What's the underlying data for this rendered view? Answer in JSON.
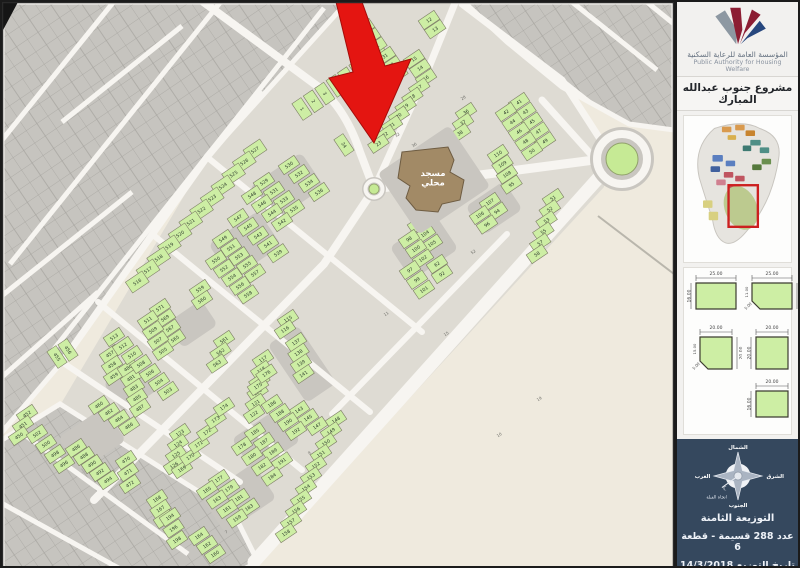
{
  "sidebar": {
    "org_name_ar": "المؤسسة العامة للرعاية السكنية",
    "org_name_en": "Public Authority for Housing Welfare",
    "project_title": "مشروع جنوب عبدالله المبارك",
    "compass": {
      "north": "الشمال",
      "east": "الشرق",
      "west": "الغرب",
      "south": "الجنوب",
      "qibla": "اتجاه القبلة"
    },
    "plot_diagrams": [
      {
        "top": "25.00",
        "side": "16.00",
        "side_pos": "left",
        "chamfer": null
      },
      {
        "top": "25.00",
        "side": "16.00",
        "side_pos": "right",
        "chamfer": [
          "11.00",
          "5.00"
        ]
      },
      {
        "top": "20.00",
        "side": "20.00",
        "side_pos": "right",
        "chamfer": [
          "15.00",
          "5.00"
        ]
      },
      {
        "top": "20.00",
        "side": "20.00",
        "side_pos": "left",
        "chamfer": null
      },
      {
        "top": "20.00",
        "side": "16.00",
        "side_pos": "left",
        "chamfer": null
      }
    ],
    "footer": {
      "line1": "التوزيعة الثامنة",
      "line2": "عدد 288 قسيمة - قطعة 6",
      "line3": "تاريخ التوزيع 14/3/2018"
    }
  },
  "map": {
    "mosque_label_lines": [
      "مسجد",
      "محلي"
    ],
    "colors": {
      "plot_green": "#cdeea4",
      "plot_stroke": "#7c7c64",
      "road": "#f7f5f1",
      "dev_base": "#dedbd3",
      "gray_zone": "#c6c4bf",
      "desert": "#efeade",
      "court": "#c9c6c0",
      "mosque": "#a28a66",
      "arrow_red": "#e41511",
      "roundabout_green": "#c6ea95",
      "footer_navy": "#35485e"
    },
    "street_numbers": [
      {
        "n": "32",
        "x": 396,
        "y": 134
      },
      {
        "n": "36",
        "x": 413,
        "y": 144
      },
      {
        "n": "28",
        "x": 462,
        "y": 97
      },
      {
        "n": "52",
        "x": 472,
        "y": 251
      },
      {
        "n": "15",
        "x": 445,
        "y": 333
      },
      {
        "n": "11",
        "x": 385,
        "y": 313
      },
      {
        "n": "19",
        "x": 538,
        "y": 398
      },
      {
        "n": "10",
        "x": 498,
        "y": 434
      },
      {
        "n": "9",
        "x": 308,
        "y": 452
      },
      {
        "n": "7",
        "x": 225,
        "y": 531
      }
    ],
    "blocks": [
      {
        "t": "r",
        "x": 300,
        "y": 107,
        "dx": 11.4,
        "dy": -7.7,
        "nums": [
          1,
          2,
          3,
          4,
          5,
          6,
          7,
          8
        ]
      },
      {
        "t": "c",
        "x": 362,
        "y": 26,
        "dx": 6.2,
        "dy": 9.2,
        "nums": [
          9,
          10,
          11
        ]
      },
      {
        "t": "c",
        "x": 427,
        "y": 18,
        "dx": 6.2,
        "dy": 9.2,
        "nums": [
          12,
          13
        ]
      },
      {
        "t": "c",
        "x": 383,
        "y": 54,
        "dx": 6.2,
        "dy": 9.2,
        "nums": [
          31,
          33,
          35
        ]
      },
      {
        "t": "c",
        "x": 412,
        "y": 57,
        "dx": 6.2,
        "dy": 9.2,
        "nums": [
          15,
          14
        ]
      },
      {
        "t": "c",
        "x": 424,
        "y": 76,
        "dx": -6.8,
        "dy": 9.4,
        "nums": [
          16,
          17,
          18,
          19,
          20,
          21,
          22,
          23
        ]
      },
      {
        "t": "r",
        "x": 342,
        "y": 143,
        "dx": 0,
        "dy": 0,
        "nums": [
          24
        ]
      },
      {
        "t": "c",
        "x": 464,
        "y": 110,
        "dx": -3,
        "dy": 10.5,
        "nums": [
          36,
          37,
          38
        ]
      },
      {
        "t": "c",
        "x": 517,
        "y": 100,
        "dx": 6.5,
        "dy": 9.8,
        "nums": [
          41,
          43,
          45,
          47,
          49
        ]
      },
      {
        "t": "c",
        "x": 504,
        "y": 110,
        "dx": 6.5,
        "dy": 9.8,
        "nums": [
          42,
          44,
          46,
          48,
          50
        ]
      },
      {
        "t": "c",
        "x": 496,
        "y": 152,
        "dx": 4.5,
        "dy": 10.2,
        "nums": [
          110,
          109,
          108,
          95
        ]
      },
      {
        "t": "c",
        "x": 551,
        "y": 196,
        "dx": -3.2,
        "dy": 11.2,
        "nums": [
          51,
          52,
          53,
          55,
          57,
          58
        ]
      },
      {
        "t": "c",
        "x": 488,
        "y": 200,
        "dx": 7,
        "dy": 9.5,
        "nums": [
          107,
          94
        ]
      },
      {
        "t": "c",
        "x": 478,
        "y": 213,
        "dx": 7,
        "dy": 9.5,
        "nums": [
          106,
          96
        ]
      },
      {
        "t": "c",
        "x": 416,
        "y": 222,
        "dx": 7,
        "dy": 9.8,
        "nums": [
          103,
          104,
          105
        ]
      },
      {
        "t": "c",
        "x": 407,
        "y": 237,
        "dx": 7,
        "dy": 9.8,
        "nums": [
          98,
          100,
          102
        ]
      },
      {
        "t": "c",
        "x": 408,
        "y": 268,
        "dx": 7,
        "dy": 9.8,
        "nums": [
          97,
          99,
          101
        ]
      },
      {
        "t": "c",
        "x": 435,
        "y": 262,
        "dx": 5,
        "dy": 10,
        "nums": [
          62,
          92
        ]
      },
      {
        "t": "c",
        "x": 286,
        "y": 317,
        "dx": -3,
        "dy": 10.5,
        "nums": [
          115,
          116
        ]
      },
      {
        "t": "c",
        "x": 294,
        "y": 340,
        "dx": 2.5,
        "dy": 10.7,
        "nums": [
          137,
          138,
          139,
          141
        ]
      },
      {
        "t": "c",
        "x": 297,
        "y": 408,
        "dx": 9,
        "dy": 8,
        "nums": [
          143,
          145,
          147
        ]
      },
      {
        "t": "c",
        "x": 261,
        "y": 357,
        "dx": -1.8,
        "dy": 11,
        "nums": [
          117,
          118,
          119,
          120,
          121,
          122
        ]
      },
      {
        "t": "c",
        "x": 178,
        "y": 431,
        "dx": -2,
        "dy": 10.8,
        "nums": [
          123,
          124,
          125,
          126
        ]
      },
      {
        "t": "c",
        "x": 180,
        "y": 467,
        "dx": 8.4,
        "dy": -12.4,
        "nums": [
          169,
          170,
          171,
          172,
          173,
          174
        ]
      },
      {
        "t": "c",
        "x": 256,
        "y": 384,
        "dx": 8.4,
        "dy": -12.4,
        "nums": [
          175,
          176
        ]
      },
      {
        "t": "c",
        "x": 270,
        "y": 402,
        "dx": 8,
        "dy": 9,
        "nums": [
          186,
          188,
          190,
          192
        ]
      },
      {
        "t": "c",
        "x": 253,
        "y": 430,
        "dx": 9,
        "dy": 9.8,
        "nums": [
          185,
          187,
          189,
          191
        ]
      },
      {
        "t": "c",
        "x": 240,
        "y": 444,
        "dx": 10,
        "dy": 10.2,
        "nums": [
          178,
          180,
          182,
          184
        ]
      },
      {
        "t": "c",
        "x": 217,
        "y": 477,
        "dx": 10,
        "dy": 9.5,
        "nums": [
          177,
          179,
          181,
          183
        ]
      },
      {
        "t": "c",
        "x": 205,
        "y": 488,
        "dx": 10,
        "dy": 9.5,
        "nums": [
          165,
          163,
          161,
          159
        ]
      },
      {
        "t": "c",
        "x": 334,
        "y": 418,
        "dx": -5,
        "dy": 11.3,
        "nums": [
          148,
          149,
          150,
          151,
          152,
          153,
          154,
          155,
          156,
          157,
          158
        ]
      },
      {
        "t": "c",
        "x": 155,
        "y": 497,
        "dx": 3.5,
        "dy": 10,
        "nums": [
          168,
          167,
          166
        ]
      },
      {
        "t": "c",
        "x": 168,
        "y": 515,
        "dx": 3.5,
        "dy": 11.5,
        "nums": [
          194,
          196,
          198
        ]
      },
      {
        "t": "c",
        "x": 197,
        "y": 534,
        "dx": 8,
        "dy": 9,
        "nums": [
          164,
          162,
          160
        ]
      },
      {
        "t": "c",
        "x": 25,
        "y": 412,
        "dx": -4,
        "dy": 11,
        "nums": [
          452,
          451,
          450
        ]
      },
      {
        "t": "r",
        "x": 55,
        "y": 355,
        "dx": 11,
        "dy": -7,
        "nums": [
          455,
          456
        ]
      },
      {
        "t": "c",
        "x": 108,
        "y": 352,
        "dx": 2,
        "dy": 11,
        "nums": [
          457,
          458,
          459
        ]
      },
      {
        "t": "c",
        "x": 97,
        "y": 403,
        "dx": 10,
        "dy": 7,
        "nums": [
          460,
          462,
          464,
          466
        ]
      },
      {
        "t": "c",
        "x": 124,
        "y": 458,
        "dx": 2,
        "dy": 12,
        "nums": [
          470,
          471,
          472
        ]
      },
      {
        "t": "c",
        "x": 35,
        "y": 432,
        "dx": 9,
        "dy": 10,
        "nums": [
          502,
          500,
          498,
          496
        ]
      },
      {
        "t": "c",
        "x": 74,
        "y": 446,
        "dx": 8,
        "dy": 8,
        "nums": [
          486,
          488,
          490,
          492,
          494
        ]
      },
      {
        "t": "c",
        "x": 126,
        "y": 366,
        "dx": 3,
        "dy": 10,
        "nums": [
          480,
          481,
          483,
          485,
          487
        ]
      },
      {
        "t": "c",
        "x": 112,
        "y": 335,
        "dx": 9,
        "dy": 9,
        "nums": [
          513,
          512,
          510,
          508,
          506,
          504,
          503
        ]
      },
      {
        "t": "c",
        "x": 253,
        "y": 148,
        "dx": -10.7,
        "dy": 12,
        "w": 20,
        "h": 13,
        "nums": [
          527,
          526,
          525,
          524,
          523,
          522,
          521,
          520,
          519,
          518,
          517,
          516
        ]
      },
      {
        "t": "c",
        "x": 262,
        "y": 180,
        "dx": 10,
        "dy": 9,
        "nums": [
          529,
          531,
          533,
          535
        ]
      },
      {
        "t": "c",
        "x": 287,
        "y": 163,
        "dx": 10,
        "dy": 9,
        "nums": [
          530,
          532,
          534,
          536
        ]
      },
      {
        "t": "c",
        "x": 250,
        "y": 193,
        "dx": 10,
        "dy": 9,
        "nums": [
          548,
          546,
          544,
          542
        ]
      },
      {
        "t": "c",
        "x": 236,
        "y": 216,
        "dx": 10,
        "dy": 8.8,
        "nums": [
          547,
          545,
          543,
          541,
          539
        ]
      },
      {
        "t": "c",
        "x": 221,
        "y": 237,
        "dx": 8,
        "dy": 8.6,
        "nums": [
          549,
          551,
          553,
          555,
          557
        ]
      },
      {
        "t": "c",
        "x": 214,
        "y": 258,
        "dx": 8,
        "dy": 8.6,
        "nums": [
          550,
          552,
          554,
          556,
          558
        ]
      },
      {
        "t": "c",
        "x": 198,
        "y": 287,
        "dx": 2,
        "dy": 11,
        "nums": [
          559,
          560
        ]
      },
      {
        "t": "c",
        "x": 222,
        "y": 338,
        "dx": -3.5,
        "dy": 11.8,
        "nums": [
          561,
          562,
          563
        ]
      },
      {
        "t": "c",
        "x": 158,
        "y": 306,
        "dx": 5,
        "dy": 10.3,
        "nums": [
          571,
          569,
          567,
          565
        ]
      },
      {
        "t": "c",
        "x": 146,
        "y": 318,
        "dx": 5,
        "dy": 10.3,
        "nums": [
          511,
          509,
          507,
          505
        ]
      }
    ]
  }
}
